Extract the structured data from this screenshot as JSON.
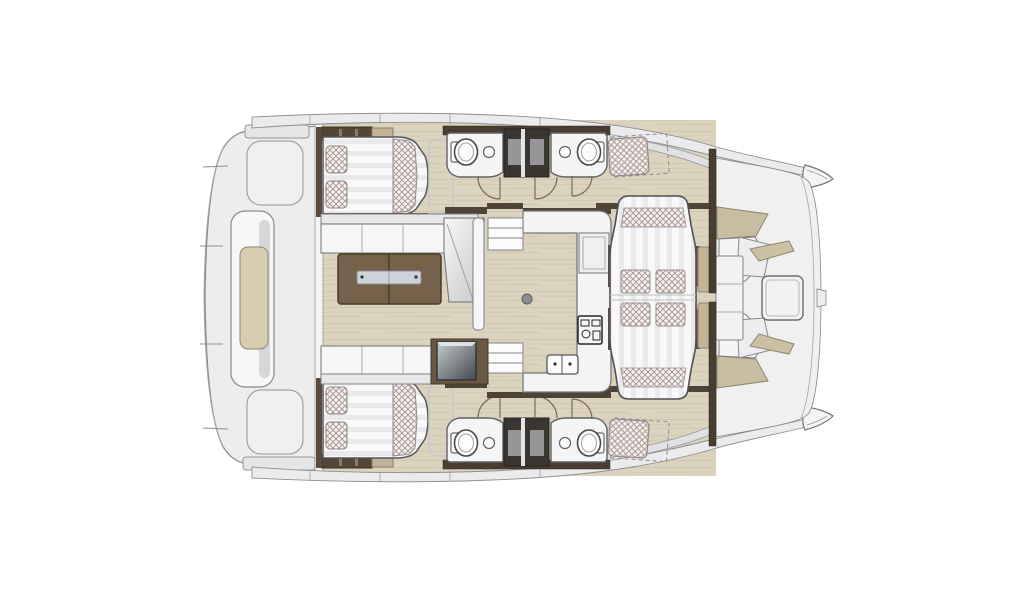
{
  "meta": {
    "title": "Catamaran interior layout plan (top view)",
    "type": "floor-plan",
    "orientation": "bows-right"
  },
  "palette": {
    "background": "#ffffff",
    "floor_wood": "#dcd3bf",
    "deck_gray": "#ededee",
    "furniture_white": "#f6f6f7",
    "wall_wood_dark": "#4e4334",
    "table_wood": "#76614a",
    "trim_tan": "#c8bda0",
    "cushion_hatch": "#ab9a9a",
    "window_navy": "#263b52",
    "appliance_gray": "#53595e",
    "outline": "#55565a"
  },
  "regions": {
    "aft_deck": {
      "label": "Aft deck platform with central sunpad lounge"
    },
    "salon": {
      "label": "Salon with sofa, chaise and folding wood table"
    },
    "galley": {
      "label": "Galley with cooktop, twin sink and refrigerator"
    },
    "dinette": {
      "label": "Central lounge berth with four cushions"
    },
    "forward_cockpit": {
      "label": "Forward cockpit seating with table"
    },
    "port_hull": {
      "label": "Port hull: double berth, two bathrooms, bow seat"
    },
    "starboard_hull": {
      "label": "Starboard hull: double berth, two bathrooms, bow seat"
    },
    "bow_window_port": {
      "label": "Port bow deck hatch window"
    },
    "bow_window_starboard": {
      "label": "Starboard bow deck hatch window"
    }
  },
  "fixtures": {
    "double_berths": 2,
    "toilets": 4,
    "bathroom_sinks": 4,
    "galley_sinks": 1,
    "cooktops": 1,
    "door_swings": 6,
    "companionway_steps": 4
  }
}
